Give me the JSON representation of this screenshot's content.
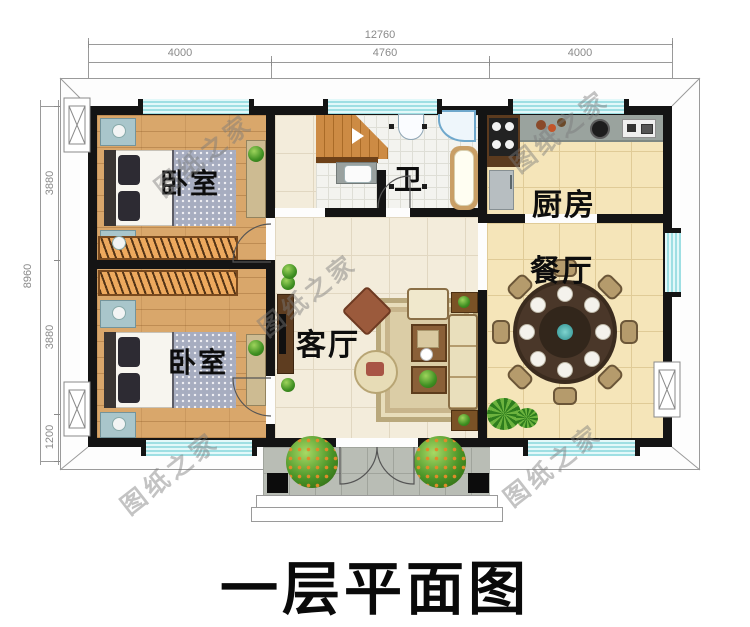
{
  "title": "一层平面图",
  "watermark": {
    "text": "图纸之家"
  },
  "dimensions": {
    "top": {
      "total": "12760",
      "segments": [
        "4000",
        "4760",
        "4000"
      ]
    },
    "left": {
      "total": "8960",
      "segments": [
        "3880",
        "3880",
        "1200"
      ]
    }
  },
  "rooms": {
    "bedroom_top": {
      "label": "卧室"
    },
    "bedroom_bottom": {
      "label": "卧室"
    },
    "bathroom": {
      "label": "卫"
    },
    "kitchen": {
      "label": "厨房"
    },
    "dining": {
      "label": "餐厅"
    },
    "living": {
      "label": "客厅"
    }
  },
  "colors": {
    "wall": "#141414",
    "window": "#9edfe3",
    "wood_floor": "#d9a76b",
    "tile_cream": "#f3ecdb",
    "tile_tan": "#f5e5b9",
    "porch": "#b9bdb5",
    "title": "#0a0a0a"
  }
}
